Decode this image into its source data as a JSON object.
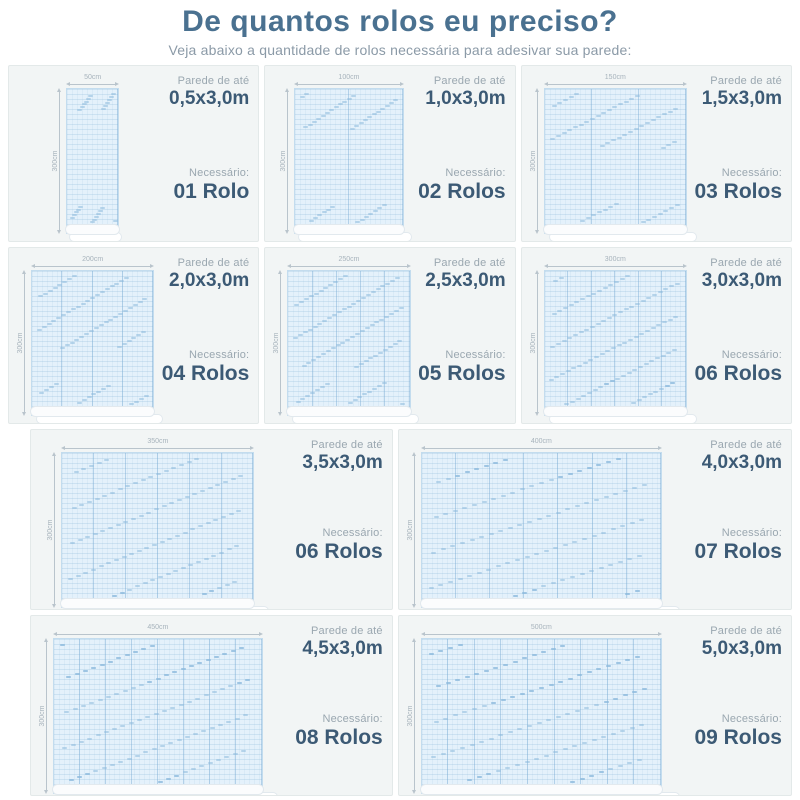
{
  "header": {
    "title": "De quantos rolos eu preciso?",
    "subtitle": "Veja abaixo a quantidade de rolos necessária para adesivar sua parede:"
  },
  "labels": {
    "wall_prefix": "Parede de até",
    "need": "Necessário:"
  },
  "colors": {
    "title": "#4a7190",
    "subtitle": "#8b9aa7",
    "value_navy": "#3c5a75",
    "muted_gray": "#9aa7b0",
    "panel_bg": "#f2f5f5",
    "wall_fill": "#e4f1fb",
    "wall_border": "#c3dcee"
  },
  "panels": [
    {
      "row": 1,
      "size": "0,5x3,0m",
      "rolls": "01 Rolo",
      "strips": 1,
      "width_label": "50cm",
      "height_label": "300cm"
    },
    {
      "row": 1,
      "size": "1,0x3,0m",
      "rolls": "02 Rolos",
      "strips": 2,
      "width_label": "100cm",
      "height_label": "300cm"
    },
    {
      "row": 1,
      "size": "1,5x3,0m",
      "rolls": "03 Rolos",
      "strips": 3,
      "width_label": "150cm",
      "height_label": "300cm"
    },
    {
      "row": 2,
      "size": "2,0x3,0m",
      "rolls": "04 Rolos",
      "strips": 4,
      "width_label": "200cm",
      "height_label": "300cm"
    },
    {
      "row": 2,
      "size": "2,5x3,0m",
      "rolls": "05 Rolos",
      "strips": 5,
      "width_label": "250cm",
      "height_label": "300cm"
    },
    {
      "row": 2,
      "size": "3,0x3,0m",
      "rolls": "06 Rolos",
      "strips": 6,
      "width_label": "300cm",
      "height_label": "300cm"
    },
    {
      "row": 3,
      "size": "3,5x3,0m",
      "rolls": "06 Rolos",
      "strips": 6,
      "width_label": "350cm",
      "height_label": "300cm"
    },
    {
      "row": 3,
      "size": "4,0x3,0m",
      "rolls": "07 Rolos",
      "strips": 7,
      "width_label": "400cm",
      "height_label": "300cm"
    },
    {
      "row": 4,
      "size": "4,5x3,0m",
      "rolls": "08 Rolos",
      "strips": 8,
      "width_label": "450cm",
      "height_label": "300cm"
    },
    {
      "row": 4,
      "size": "5,0x3,0m",
      "rolls": "09 Rolos",
      "strips": 9,
      "width_label": "500cm",
      "height_label": "300cm"
    }
  ]
}
